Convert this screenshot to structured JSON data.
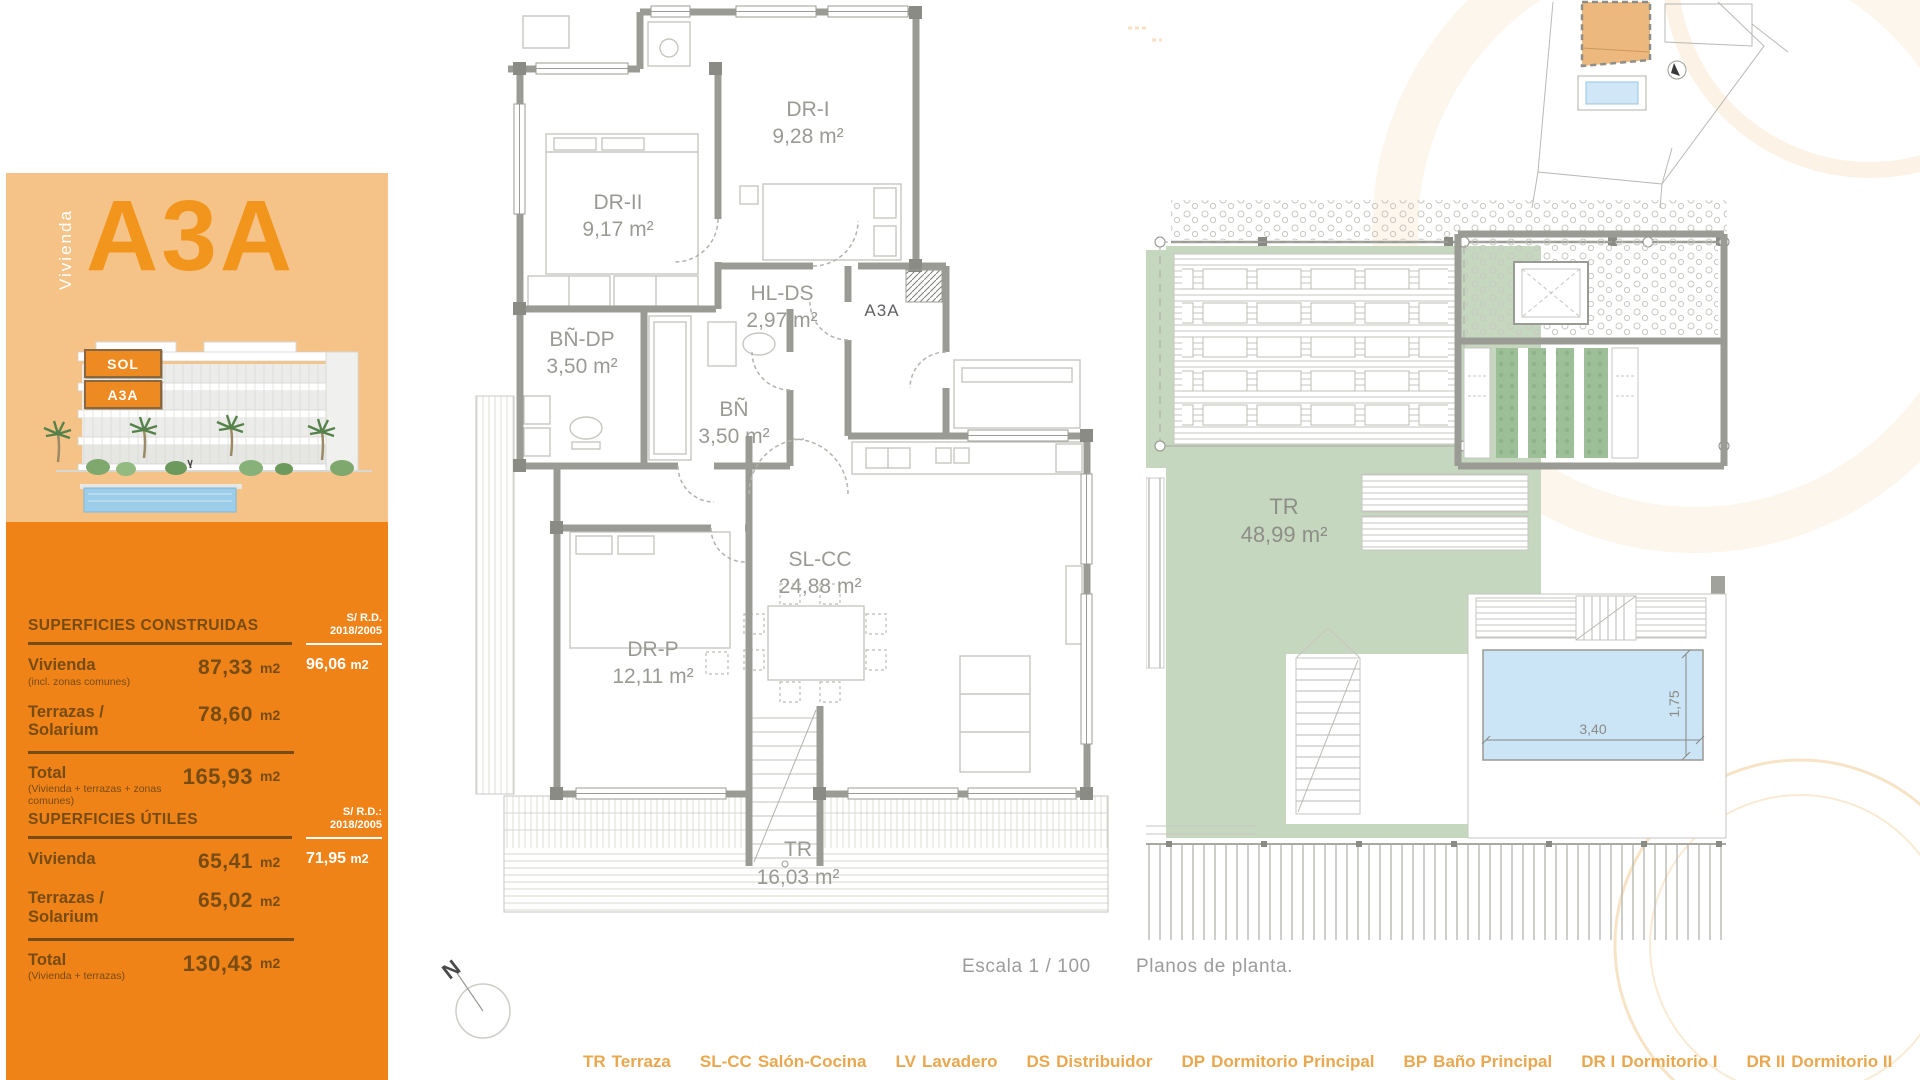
{
  "sidebar": {
    "unit_label": "Vivienda",
    "unit_code": "A3A",
    "tags": [
      {
        "label": "SOL"
      },
      {
        "label": "A3A"
      }
    ],
    "tables": [
      {
        "title": "SUPERFICIES CONSTRUIDAS",
        "rd_header": "S/ R.D.\n2018/2005",
        "rows": [
          {
            "label": "Vivienda",
            "sublabel": "(incl. zonas comunes)",
            "value": "87,33",
            "unit": "m2",
            "rd_value": "96,06",
            "rd_unit": "m2"
          },
          {
            "label": "Terrazas / Solarium",
            "value": "78,60",
            "unit": "m2"
          }
        ],
        "total": {
          "label": "Total",
          "sublabel": "(Vivienda + terrazas + zonas comunes)",
          "value": "165,93",
          "unit": "m2"
        }
      },
      {
        "title": "SUPERFICIES ÚTILES",
        "rd_header": "S/ R.D.:\n2018/2005",
        "rows": [
          {
            "label": "Vivienda",
            "value": "65,41",
            "unit": "m2",
            "rd_value": "71,95",
            "rd_unit": "m2"
          },
          {
            "label": "Terrazas / Solarium",
            "value": "65,02",
            "unit": "m2"
          }
        ],
        "total": {
          "label": "Total",
          "sublabel": "(Vivienda + terrazas)",
          "value": "130,43",
          "unit": "m2"
        }
      }
    ]
  },
  "plan": {
    "unit_marker": "A3A",
    "north_label": "N",
    "rooms": [
      {
        "code": "DR-II",
        "area": "9,17 m²"
      },
      {
        "code": "DR-I",
        "area": "9,28 m²"
      },
      {
        "code": "HL-DS",
        "area": "2,97 m²"
      },
      {
        "code": "BÑ-DP",
        "area": "3,50 m²"
      },
      {
        "code": "BÑ",
        "area": "3,50 m²"
      },
      {
        "code": "SL-CC",
        "area": "24,88 m²"
      },
      {
        "code": "DR-P",
        "area": "12,11 m²"
      },
      {
        "code": "TR",
        "area": "16,03 m²"
      }
    ]
  },
  "roof_plan": {
    "tr": {
      "code": "TR",
      "area": "48,99 m²"
    },
    "pool": {
      "width_label": "3,40",
      "height_label": "1,75"
    }
  },
  "footer": {
    "scale_label": "Escala 1 / 100",
    "plans_label": "Planos de planta.",
    "legend": [
      {
        "code": "TR",
        "name": "Terraza"
      },
      {
        "code": "SL-CC",
        "name": "Salón-Cocina"
      },
      {
        "code": "LV",
        "name": "Lavadero"
      },
      {
        "code": "DS",
        "name": "Distribuidor"
      },
      {
        "code": "DP",
        "name": "Dormitorio Principal"
      },
      {
        "code": "BP",
        "name": "Baño Principal"
      },
      {
        "code": "DR I",
        "name": "Dormitorio I"
      },
      {
        "code": "DR II",
        "name": "Dormitorio II"
      },
      {
        "code": "BÑ",
        "name": "Baño"
      },
      {
        "code": "JR",
        "name": "Jardín"
      }
    ]
  },
  "colors": {
    "sidebar_light": "#F5C387",
    "sidebar_dark": "#EF8318",
    "accent_orange": "#F2951D",
    "table_text": "#774B14",
    "legend_text": "#E9A850",
    "plan_wall": "#9B9B95",
    "terrace_green": "#C6D7BF",
    "pool_blue": "#CBE4F6"
  }
}
